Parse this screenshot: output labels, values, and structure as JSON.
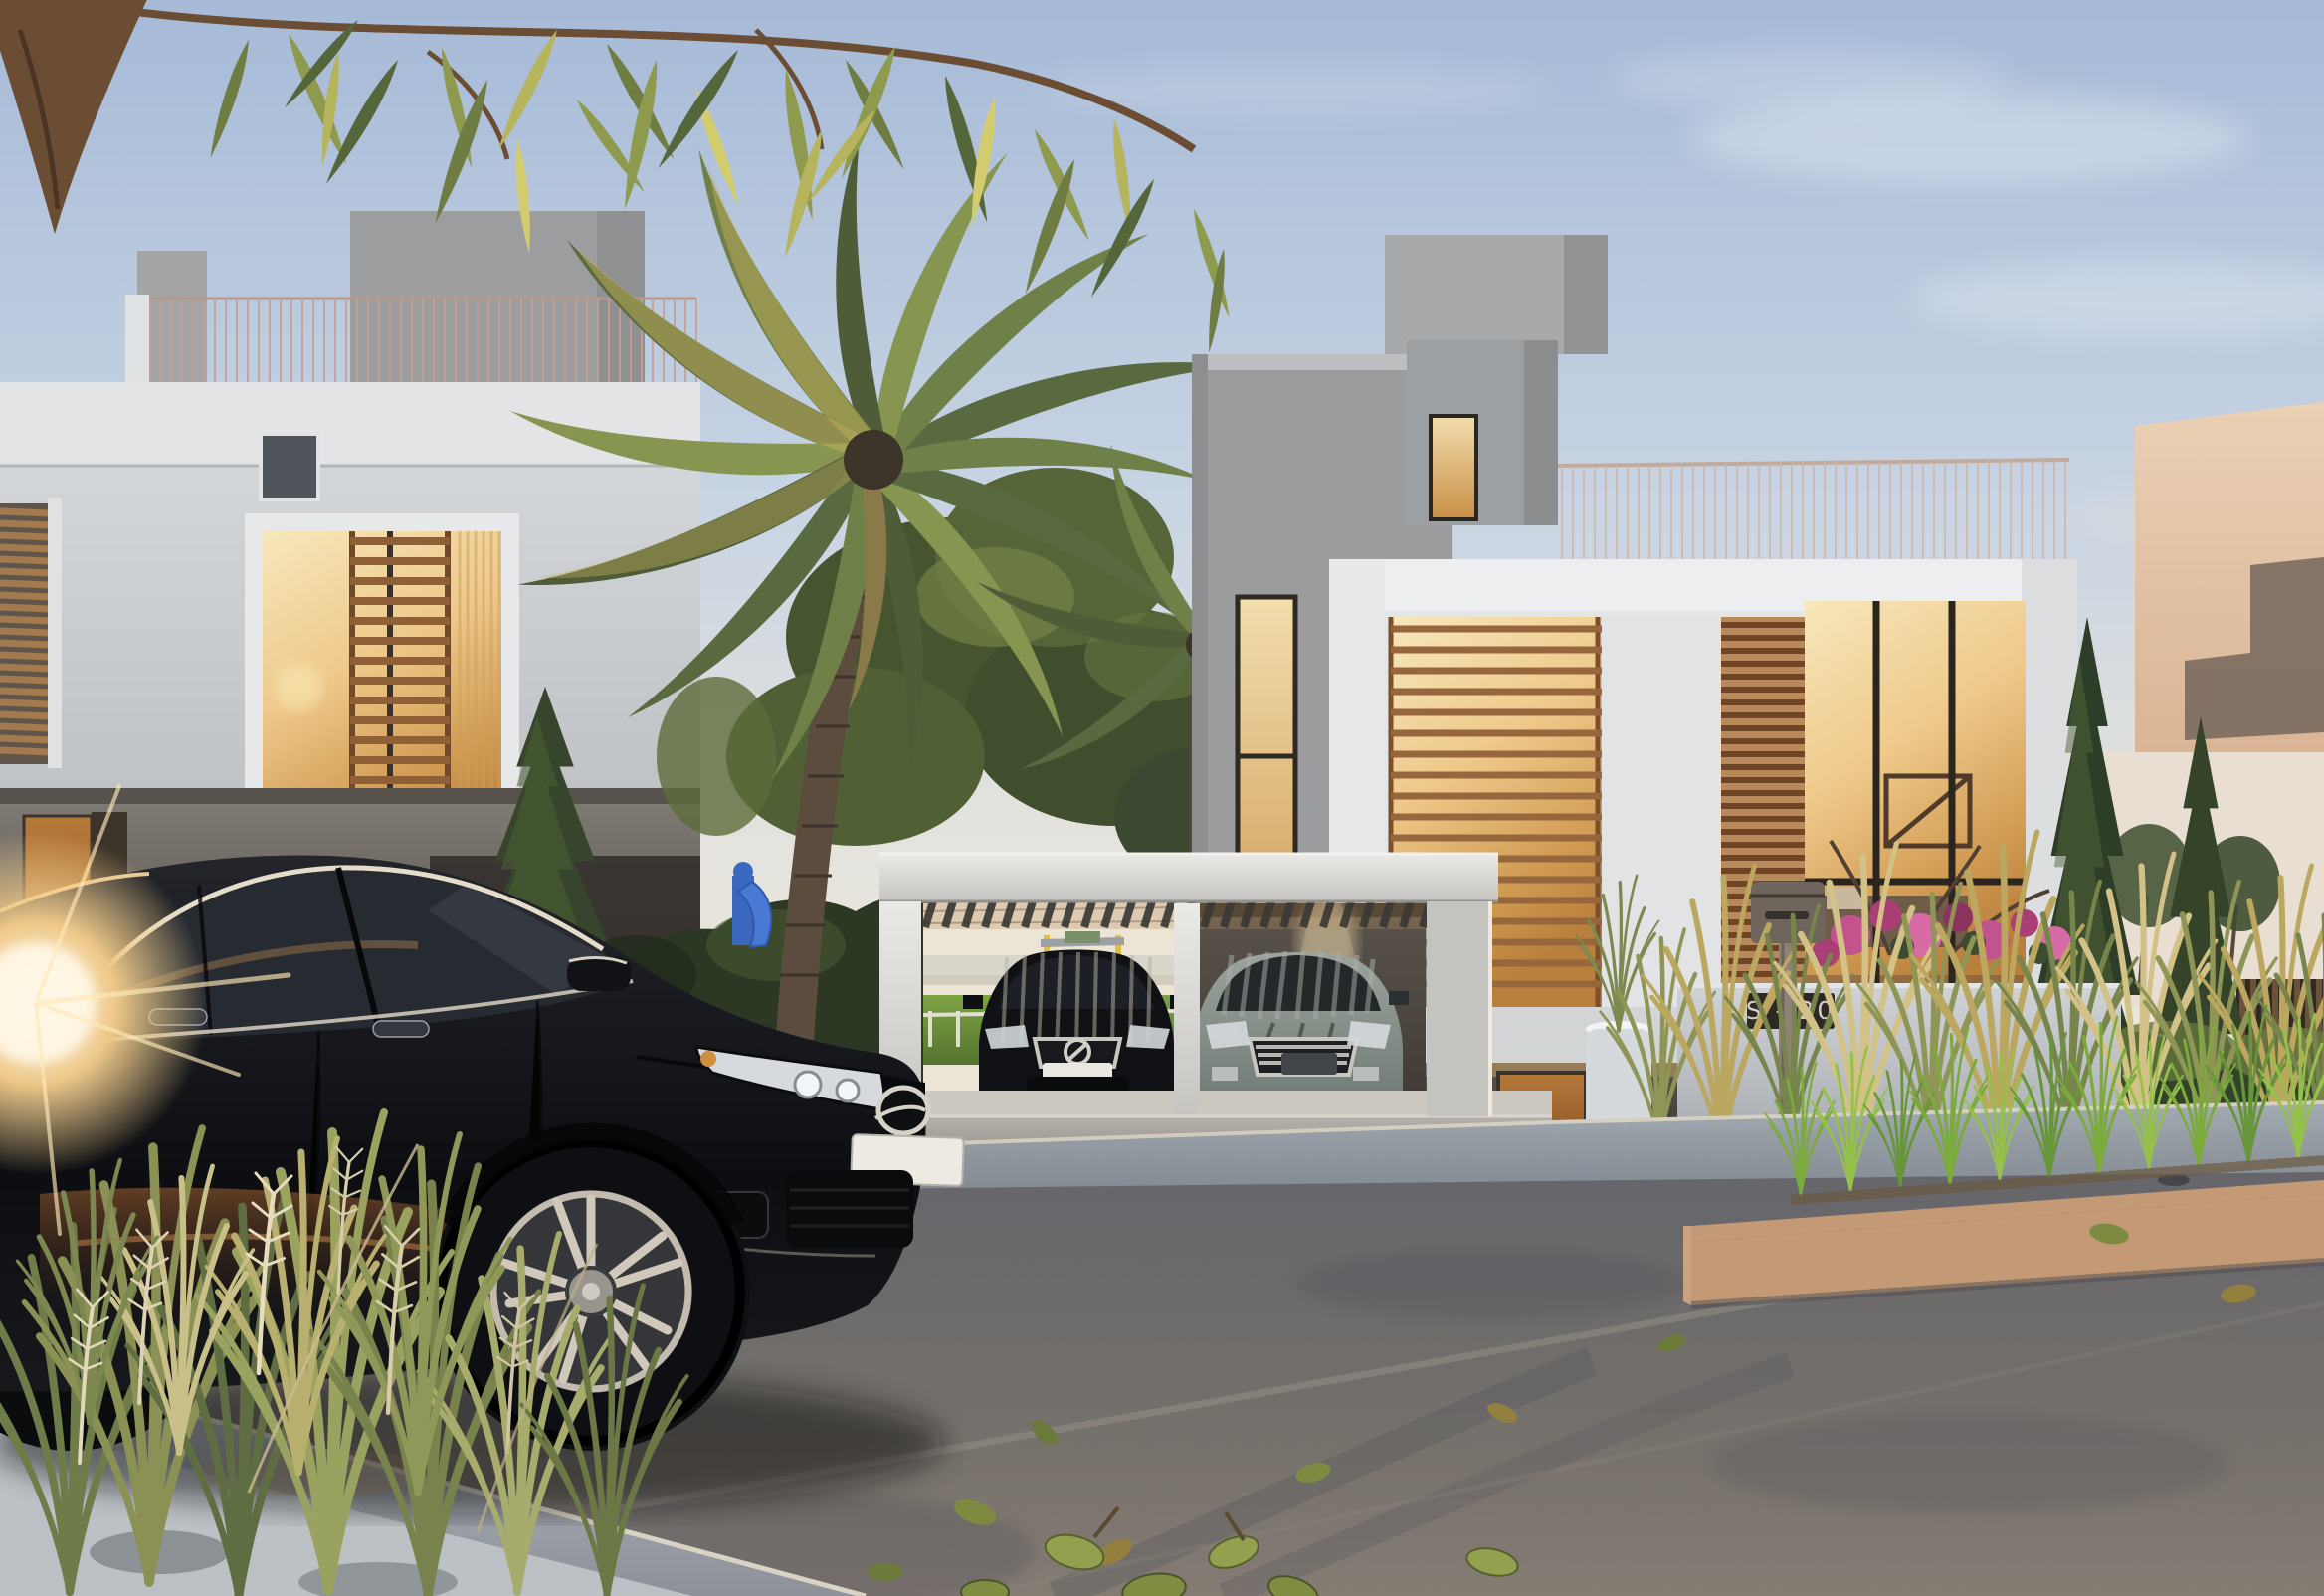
{
  "scene": {
    "title": "Dusk exterior rendering of a modern villa street",
    "time_of_day": "dusk",
    "setting": "Residential compound street: two modern villas with warm lit windows, date palm, carport with two parked cars, black sedan in foreground, ornamental grasses and asphalt road",
    "sign": {
      "label": "S - 20"
    },
    "foreground_car": {
      "type": "black sedan, three-quarter front view",
      "license_plate": ""
    },
    "carport_cars": [
      {
        "type": "black compact car",
        "license_plate": ""
      },
      {
        "type": "grey-green sedan",
        "license_plate": ""
      }
    ],
    "palette": {
      "sky_top": "#a6bad7",
      "sky_horizon": "#efe8dc",
      "window_glow": "#eec889",
      "window_glow_deep": "#b97f3c",
      "facade_light": "#d8dbdd",
      "wood_slat": "#96663c",
      "asphalt": "#757069",
      "lawn": "#7da344",
      "planter_stone": "#c49a76",
      "car_black": "#0d0e12",
      "carport_white": "#ebe9e6",
      "peach_wall": "#ead0b4",
      "sign_bg": "#2d2925",
      "sign_text": "#d6d1c7",
      "plate": "#eceae3"
    },
    "objects": [
      {
        "name": "overhanging-branch",
        "label": "Overhanging tree branch with backlit leaves"
      },
      {
        "name": "left-villa",
        "label": "Left villa with roof railing, lit picture window and wood louvers"
      },
      {
        "name": "palm-tree",
        "label": "Large date palm"
      },
      {
        "name": "playground-slide",
        "label": "Blue playground slide"
      },
      {
        "name": "right-villa",
        "label": "Right villa with cantilevered lit upper floor"
      },
      {
        "name": "carport",
        "label": "White carport with slatted pergola roof"
      },
      {
        "name": "address-sign",
        "label": "Address plaque S - 20 on garden wall"
      },
      {
        "name": "mailbox",
        "label": "Mailbox on post"
      },
      {
        "name": "foreground-car",
        "label": "Black sedan parked on street"
      },
      {
        "name": "sun-flare",
        "label": "Low sun flare behind car"
      },
      {
        "name": "planter-island",
        "label": "Stone planter island with fresh grass"
      },
      {
        "name": "foreground-grasses",
        "label": "Ornamental grasses and seed plumes"
      },
      {
        "name": "peach-house",
        "label": "Neighbouring house in warm sunset light"
      }
    ]
  }
}
